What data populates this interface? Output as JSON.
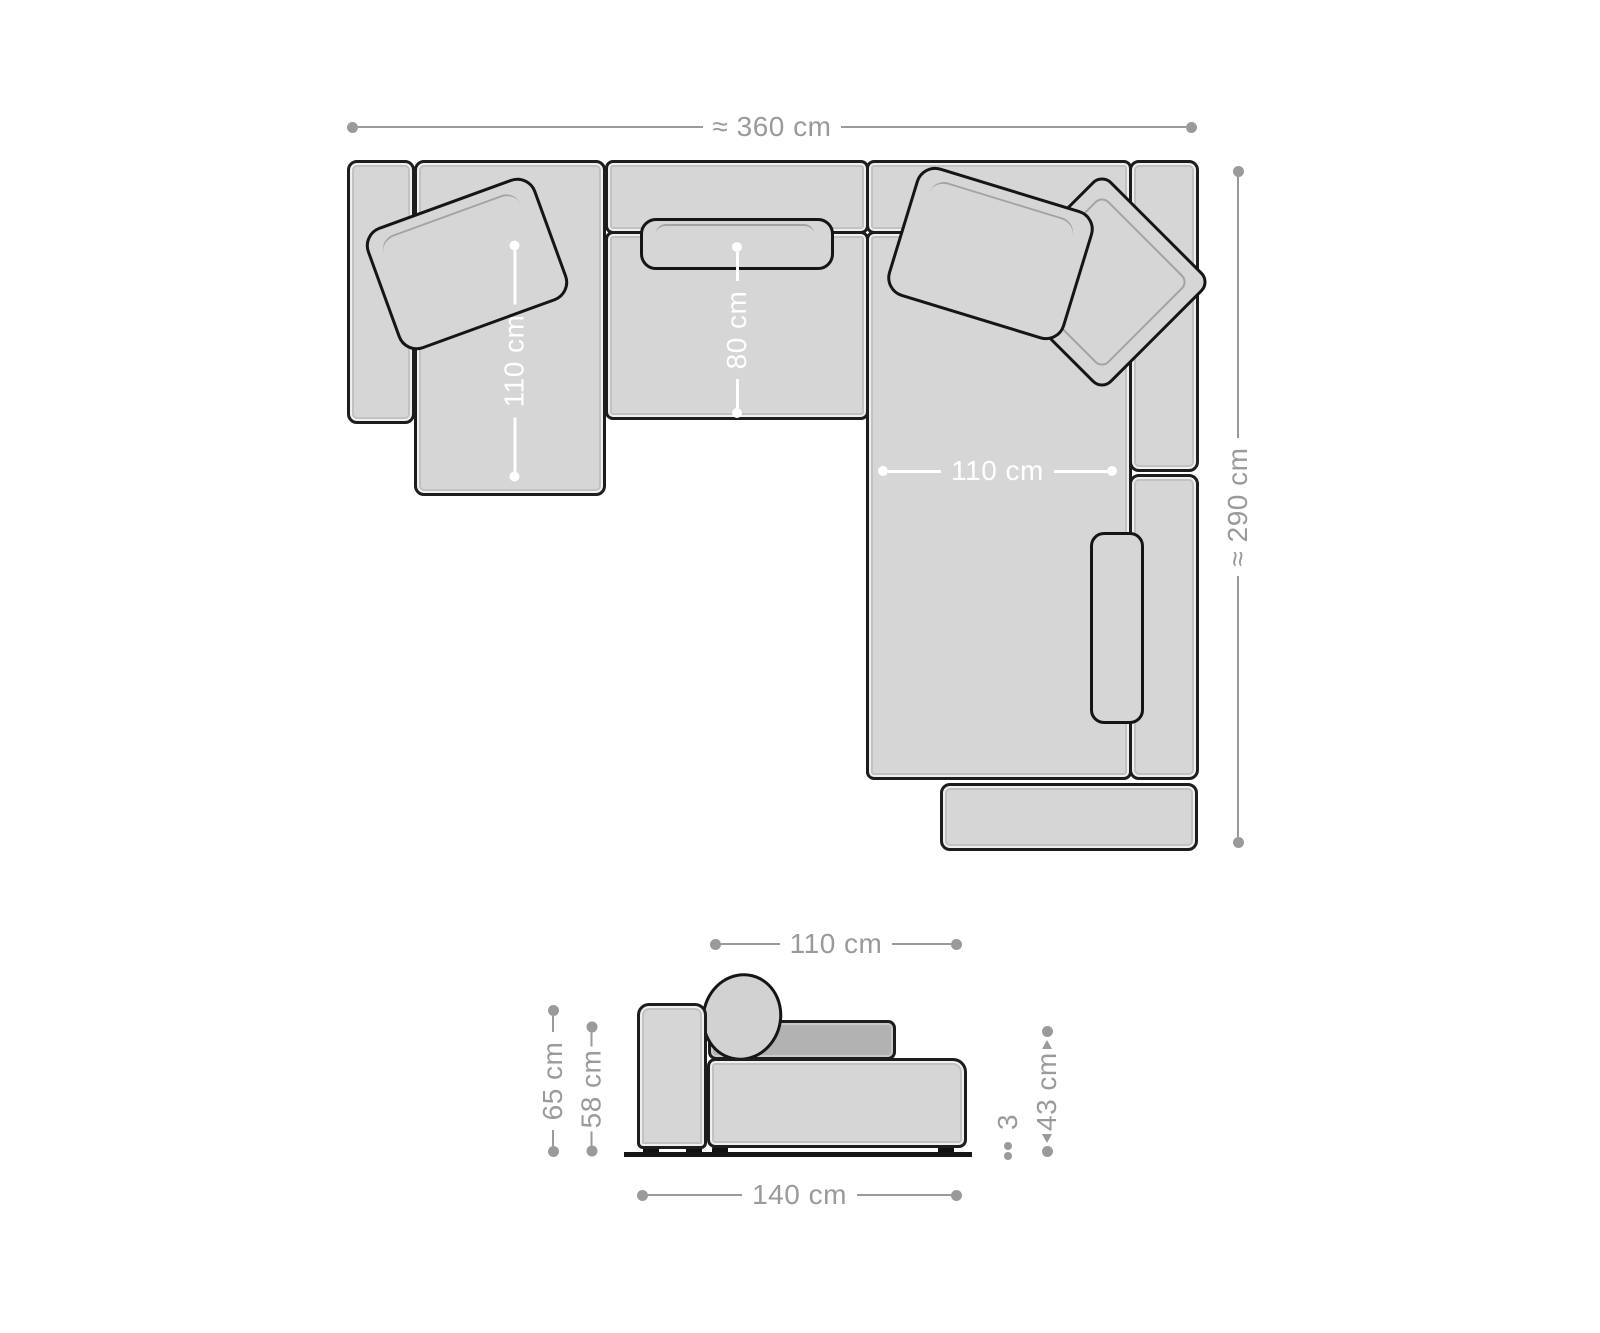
{
  "title": "Sectional sofa dimension diagram",
  "colors": {
    "background": "#ffffff",
    "outline": "#1d1d1d",
    "sofa_fill": "#d6d6d6",
    "back_cushion_fill": "#b2b2b2",
    "dimension_gray": "#9a9a9a",
    "dimension_white": "#ffffff"
  },
  "top_view": {
    "total_width": {
      "label": "≈ 360 cm"
    },
    "total_depth": {
      "label": "≈ 290 cm"
    },
    "left_chaise_depth": {
      "label": "110 cm"
    },
    "seat_depth": {
      "label": "80 cm"
    },
    "right_chaise_width": {
      "label": "110 cm"
    }
  },
  "side_view": {
    "seat_module_width": {
      "label": "110 cm"
    },
    "total_height": {
      "label": "65 cm"
    },
    "backrest_height": {
      "label": "58 cm"
    },
    "seat_height": {
      "label": "43 cm"
    },
    "foot_height": {
      "label": "3"
    },
    "total_depth": {
      "label": "140 cm"
    }
  }
}
